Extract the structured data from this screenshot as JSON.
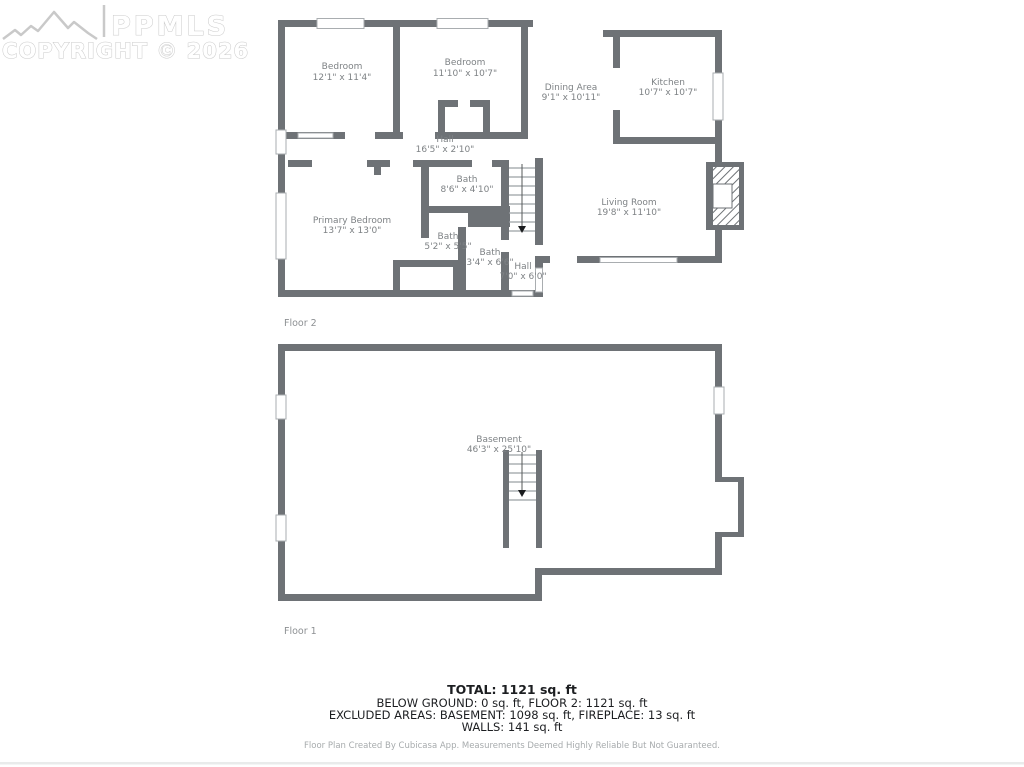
{
  "watermark": {
    "brand": "PPMLS",
    "copyright": "COPYRIGHT © 2026"
  },
  "floor2": {
    "label": "Floor 2",
    "rooms": [
      {
        "name": "Bedroom",
        "dims": "12'1\" x 11'4\""
      },
      {
        "name": "Bedroom",
        "dims": "11'10\" x 10'7\""
      },
      {
        "name": "Dining Area",
        "dims": "9'1\" x 10'11\""
      },
      {
        "name": "Kitchen",
        "dims": "10'7\" x 10'7\""
      },
      {
        "name": "Hall",
        "dims": "16'5\" x 2'10\""
      },
      {
        "name": "Bath",
        "dims": "8'6\" x 4'10\""
      },
      {
        "name": "Primary Bedroom",
        "dims": "13'7\" x 13'0\""
      },
      {
        "name": "Bath",
        "dims": "5'2\" x 5'5\""
      },
      {
        "name": "Bath",
        "dims": "3'4\" x 6'6\""
      },
      {
        "name": "Hall",
        "dims": "7'0\" x 6'0\""
      },
      {
        "name": "Living Room",
        "dims": "19'8\" x 11'10\""
      }
    ]
  },
  "floor1": {
    "label": "Floor 1",
    "rooms": [
      {
        "name": "Basement",
        "dims": "46'3\" x 25'10\""
      }
    ]
  },
  "summary": {
    "total": "TOTAL: 1121 sq. ft",
    "line2": "BELOW GROUND: 0 sq. ft, FLOOR 2: 1121 sq. ft",
    "line3": "EXCLUDED AREAS: BASEMENT: 1098 sq. ft, FIREPLACE: 13 sq. ft",
    "line4": "WALLS: 141 sq. ft",
    "footer": "Floor Plan Created By Cubicasa App. Measurements Deemed Highly Reliable But Not Guaranteed."
  },
  "colors": {
    "wall": "#6e7276",
    "window_border": "#a9adb0",
    "room_text": "#7e8285",
    "floor_text": "#8d9093",
    "summary_text": "#1c1e21",
    "footer_text": "#a7abad",
    "watermark": "#c9c9c9"
  }
}
